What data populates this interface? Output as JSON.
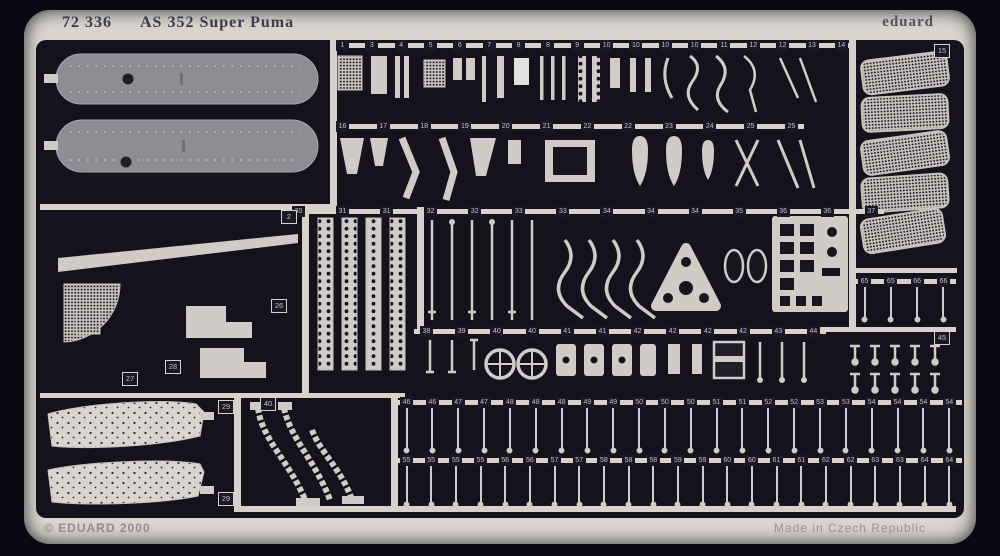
{
  "header": {
    "catalog_no": "72 336",
    "title": "AS 352 Super Puma",
    "brand": "eduard"
  },
  "footer": {
    "copyright": "© EDUARD 2000",
    "origin": "Made in Czech Republic"
  },
  "colors": {
    "background": "#090712",
    "frame": "#d9d6d0",
    "interior": "#15121d",
    "rail": "#d5d2cc",
    "part_silver": "#cfccc7",
    "rotor_blade_grey": "#8d8d93",
    "tab_background": "#1b1724",
    "tab_text": "#c3c0c8"
  },
  "labels": {
    "left_panel": "2",
    "mesh_block": "15",
    "fan_part": "26",
    "step_part_a": "27",
    "step_part_b": "28",
    "wing_top": "29",
    "wing_bottom": "29",
    "ladder": "40",
    "pin_block": "45"
  },
  "strips": {
    "row1": {
      "numbers": [
        "1",
        "3",
        "4",
        "5",
        "6",
        "7",
        "8",
        "8",
        "9",
        "10",
        "10",
        "10",
        "10",
        "11",
        "12",
        "12",
        "13",
        "14"
      ]
    },
    "row2": {
      "numbers": [
        "16",
        "17",
        "18",
        "19",
        "20",
        "21",
        "22",
        "22",
        "23",
        "24",
        "25",
        "25"
      ]
    },
    "row3": {
      "numbers": [
        "30",
        "31",
        "31",
        "32",
        "32",
        "33",
        "33",
        "34",
        "34",
        "34",
        "35",
        "36",
        "36",
        "37"
      ]
    },
    "row4": {
      "numbers": [
        "38",
        "39",
        "40",
        "40",
        "41",
        "41",
        "42",
        "42",
        "42",
        "42",
        "43",
        "44"
      ]
    },
    "row5": {
      "numbers": [
        "46",
        "46",
        "47",
        "47",
        "48",
        "48",
        "48",
        "49",
        "49",
        "50",
        "50",
        "50",
        "51",
        "51",
        "52",
        "52",
        "53",
        "53",
        "54",
        "54",
        "54",
        "54"
      ]
    },
    "row6": {
      "numbers": [
        "55",
        "55",
        "55",
        "55",
        "56",
        "56",
        "57",
        "57",
        "58",
        "58",
        "58",
        "59",
        "59",
        "60",
        "60",
        "61",
        "61",
        "62",
        "62",
        "63",
        "63",
        "64",
        "64"
      ]
    },
    "right_mid": {
      "numbers": [
        "65",
        "65",
        "66",
        "66"
      ]
    }
  }
}
